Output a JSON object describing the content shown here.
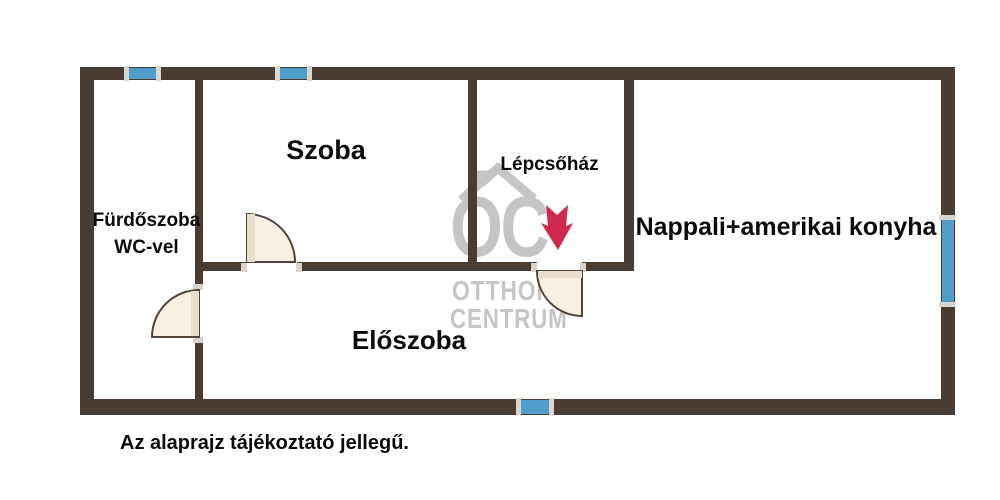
{
  "theme": {
    "bg": "#ffffff",
    "wall": "#4a3c31",
    "window": "#4f9dc8",
    "window-cap": "#d9d7d2",
    "door-fill": "#f8f1e2",
    "door-panel": "#e9decb",
    "door-stroke": "#50443a",
    "hinge": "#d7d4cf",
    "arrow": "#cf2a4d",
    "watermark": "#c6c5c3",
    "label": "#0b0b0b"
  },
  "rooms": {
    "bathroom_line1": "Fürdőszoba",
    "bathroom_line2": "WC-vel",
    "room": "Szoba",
    "staircase": "Lépcsőház",
    "living_kitchen": "Nappali+amerikai konyha",
    "hallway": "Előszoba"
  },
  "watermark": {
    "monogram": "OC",
    "word1": "OTTHON",
    "word2": "CENTRUM"
  },
  "disclaimer": "Az alaprajz tájékoztató jellegű.",
  "icons": {
    "stairs_direction": "down-arrow-icon",
    "logo_roof": "house-roof-icon"
  }
}
